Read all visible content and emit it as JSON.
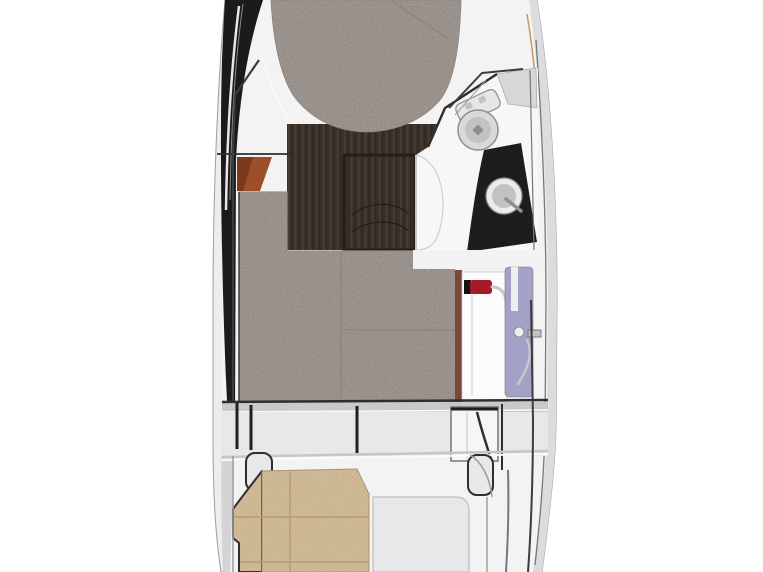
{
  "floorplan": {
    "type": "boat-interior-top-view",
    "colors": {
      "background": "#ffffff",
      "hull_shell": "#ededee",
      "hull_outline": "#9e9e9e",
      "gunwale": "#dcdcde",
      "gunwale_line": "#77777a",
      "hull_band": "#1b1b1b",
      "hull_band_lower": "#d4d4d6",
      "chrome_bright": "#f2f2f2",
      "chrome_mid": "#8a8a8a",
      "deck": "#f3f3f4",
      "deck_white": "#f7f7f8",
      "panel_light": "#e8e8ea",
      "panel_mid": "#d7d7d9",
      "notch_white": "#f2f2f3",
      "line_dark": "#2e2e2e",
      "line_black": "#1f1f21",
      "line_mid": "#9e9ea0",
      "line_soft": "#c6c6c8",
      "wood_dark": "#3a3129",
      "wood_grain": "#4e4237",
      "wood_deep": "#2a231d",
      "wood_frame": "#241f1a",
      "arc_line": "#1f1a15",
      "orange_wood": "#9c4f28",
      "orange_wood_dark": "#7c3a1c",
      "red_wood": "#7a4836",
      "mattress": "#a9a19b",
      "mattress_seam": "#8c847e",
      "mattress_edge": "#98908a",
      "grain_dark": "#57504b",
      "counter_black": "#1d1d1f",
      "metal_light": "#e6e6e8",
      "metal_mid": "#c2c2c4",
      "metal_dark": "#8f8f91",
      "bowl_fill": "#d9d9db",
      "sink_fill": "#ececee",
      "cabinet_white": "#fbfbfc",
      "cabinet_highlight": "#e3e3e5",
      "lavender": "#a3a2c6",
      "lavender_strap": "#ededf2",
      "handle_red": "#a51a28",
      "cap_black": "#141414",
      "hose_silver": "#c6c6cf",
      "cushion_tan": "#d9c29c",
      "cushion_seam": "#b49b73",
      "cushion_outline": "#2b2b2b",
      "bulkhead_band": "#c9c9cb",
      "door_white": "#f6f6f7",
      "accent_gold": "#c79a62",
      "rail_dark": "#3c3c3e",
      "highlight_white": "#fbfbfc"
    }
  }
}
